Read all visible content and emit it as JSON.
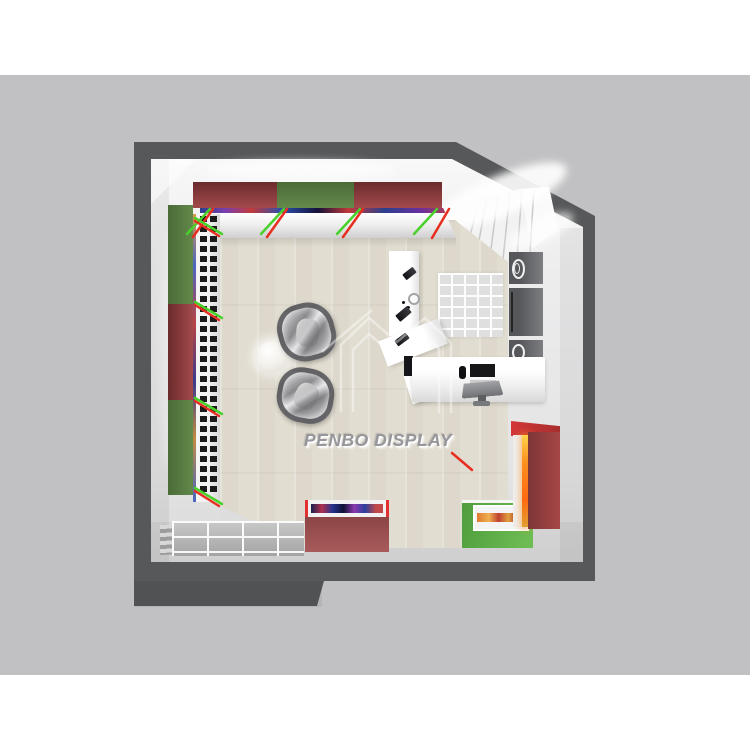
{
  "scene": {
    "watermark_text": "PENBO DISPLAY",
    "description": "Top-view 3D render of a retail watch shop interior floor plan",
    "colors": {
      "page_background": "#ffffff",
      "backdrop": "#c1c1c3",
      "outer_wall": "#565859",
      "inner_wall": "#ebebec",
      "floor_wood": "#e7e3d8",
      "cabinet_top_red": "#8a393b",
      "cabinet_top_green": "#567a40",
      "display_case_red": "#9d5152",
      "display_case_green": "#62ad49",
      "trim_red": "#e82e20",
      "trim_green": "#49d12c",
      "lightbox_glow": "#ff9020",
      "seat_gray": "#9a9a9c"
    },
    "fixtures": {
      "top_wall_cabinets": [
        "red",
        "green",
        "red"
      ],
      "left_wall_cabinets": [
        "green",
        "red",
        "green"
      ],
      "floor_cases": [
        "red-display-case",
        "green-display-case"
      ],
      "right_side": [
        "staircase",
        "storage-box",
        "storage-box",
        "storage-box",
        "cube-shelf",
        "cashier-desk",
        "red-lightbox-cabinet"
      ],
      "center": [
        "round-table",
        "armchair",
        "armchair"
      ]
    }
  }
}
